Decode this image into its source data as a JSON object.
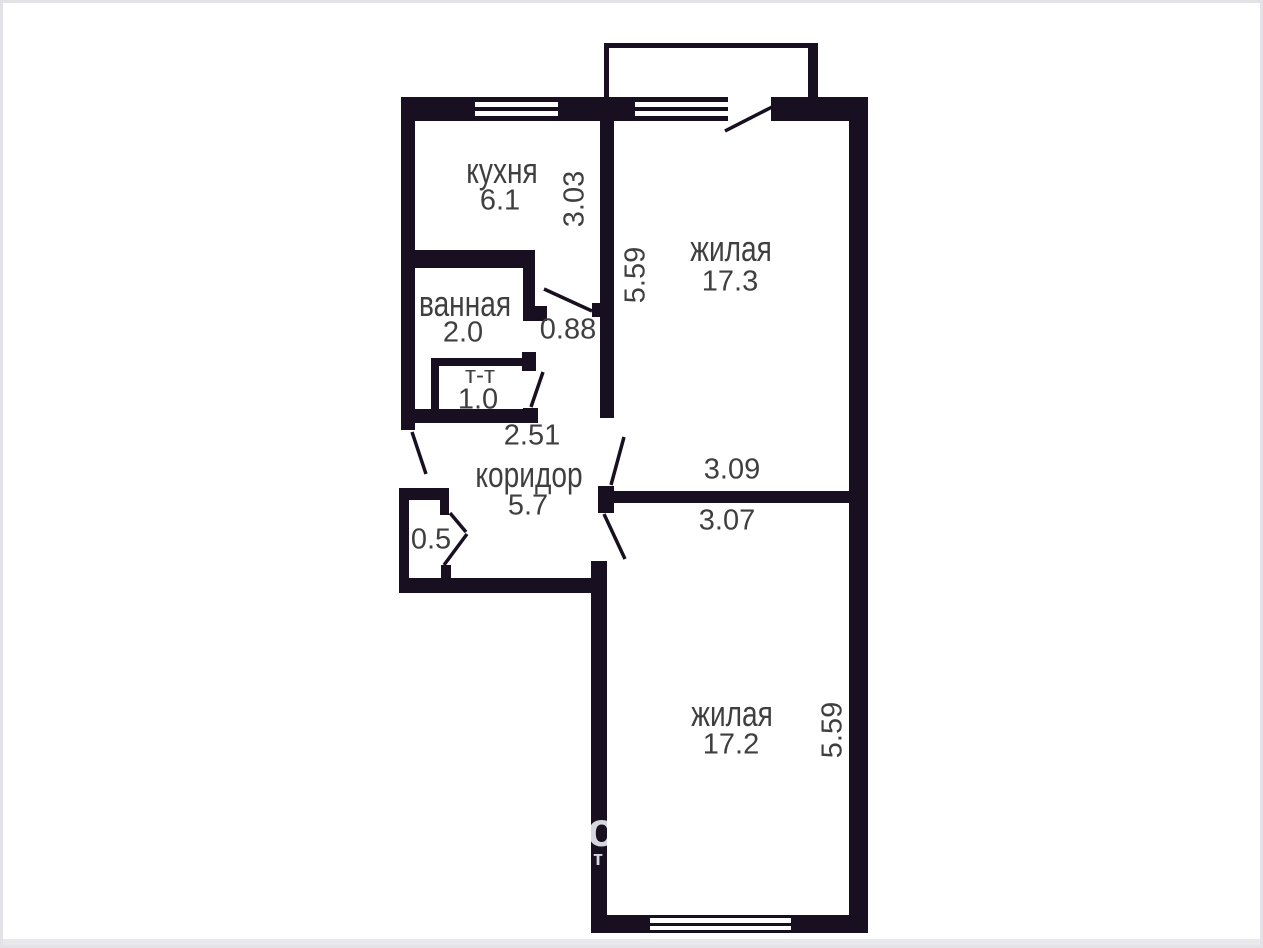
{
  "rooms": {
    "kitchen": {
      "name": "кухня",
      "area": "6.1"
    },
    "living1": {
      "name": "жилая",
      "area": "17.3"
    },
    "bathroom": {
      "name": "ванная",
      "area": "2.0"
    },
    "toilet": {
      "name": "т-т",
      "area": "1.0"
    },
    "corridor": {
      "name": "коридор",
      "area": "5.7"
    },
    "closet": {
      "area": "0.5"
    },
    "living2": {
      "name": "жилая",
      "area": "17.2"
    }
  },
  "dimensions": {
    "kitchen_width": "3.03",
    "living1_height": "5.59",
    "bathroom_door_width": "0.88",
    "corridor_width": "2.51",
    "living1_width": "3.09",
    "living2_width": "3.07",
    "living2_height": "5.59"
  },
  "watermark": {
    "large_fragment": "о",
    "small_fragment": "нт"
  },
  "colors": {
    "wall": "#181021",
    "label_text": "#3f3f3f",
    "watermark": "#d6d6de",
    "frame_border": "#e3e3e7"
  }
}
